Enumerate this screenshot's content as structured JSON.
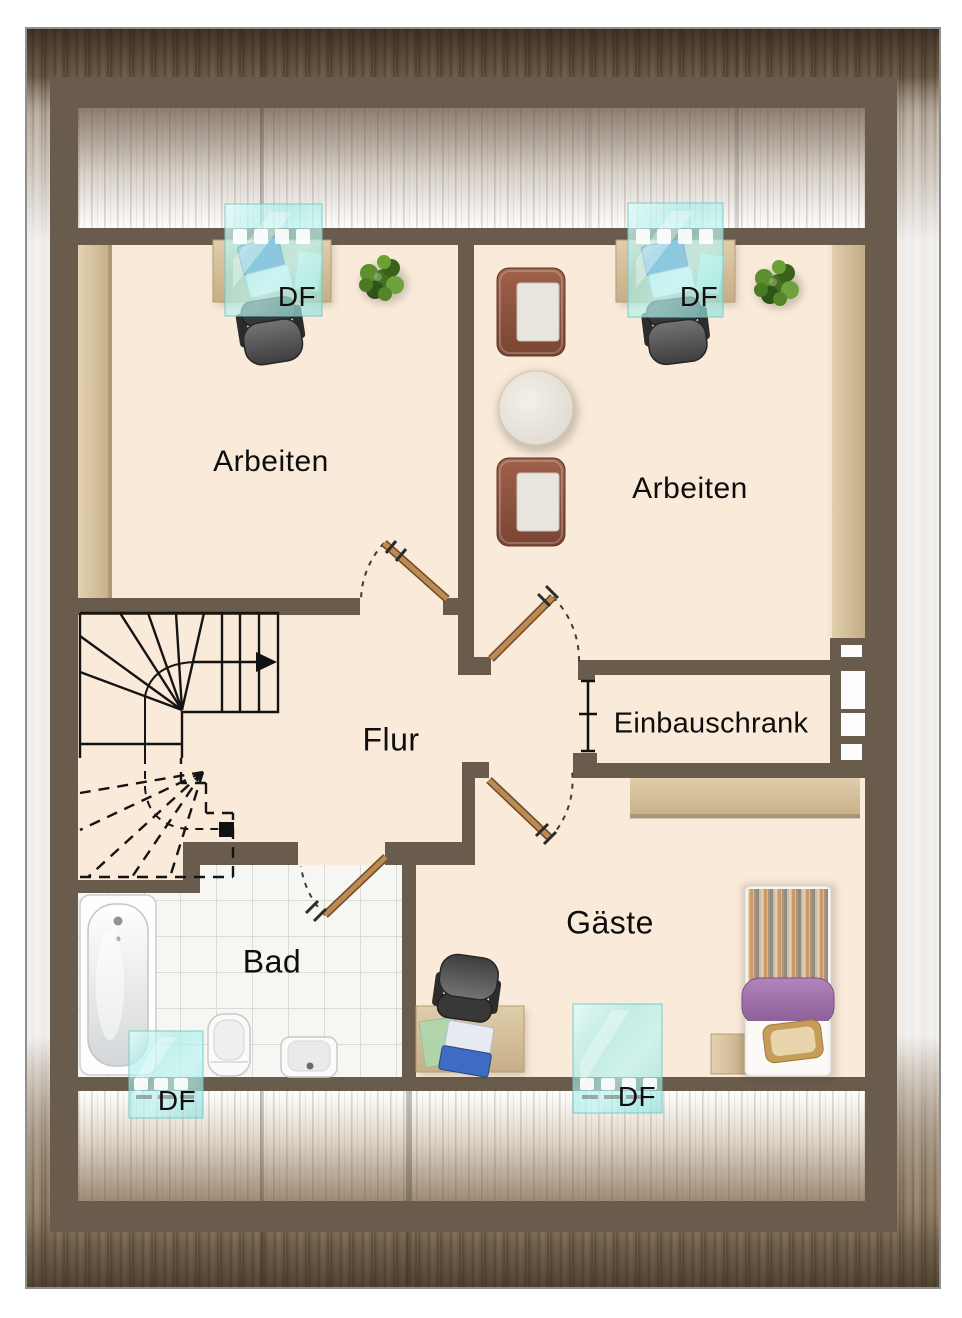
{
  "plan": {
    "type": "floor-plan",
    "rooms": {
      "arbeiten_left": {
        "label": "Arbeiten"
      },
      "arbeiten_right": {
        "label": "Arbeiten"
      },
      "flur": {
        "label": "Flur"
      },
      "einbauschrank": {
        "label": "Einbauschrank"
      },
      "bad": {
        "label": "Bad"
      },
      "gaeste": {
        "label": "Gäste"
      }
    },
    "roof_windows": {
      "arbeiten_left": {
        "label": "DF"
      },
      "arbeiten_right": {
        "label": "DF"
      },
      "bad": {
        "label": "DF"
      },
      "gaeste": {
        "label": "DF"
      }
    },
    "colors": {
      "wall": "#6a5c4c",
      "floor": "#faead9",
      "tiles": "#f6f6f3",
      "wood": "#d8c5a1",
      "roof_window": "#9fe4e0",
      "door_leaf": "#bc8a55",
      "frame_wood": "#8d7b66",
      "bed_accent": "#a06cab"
    }
  }
}
